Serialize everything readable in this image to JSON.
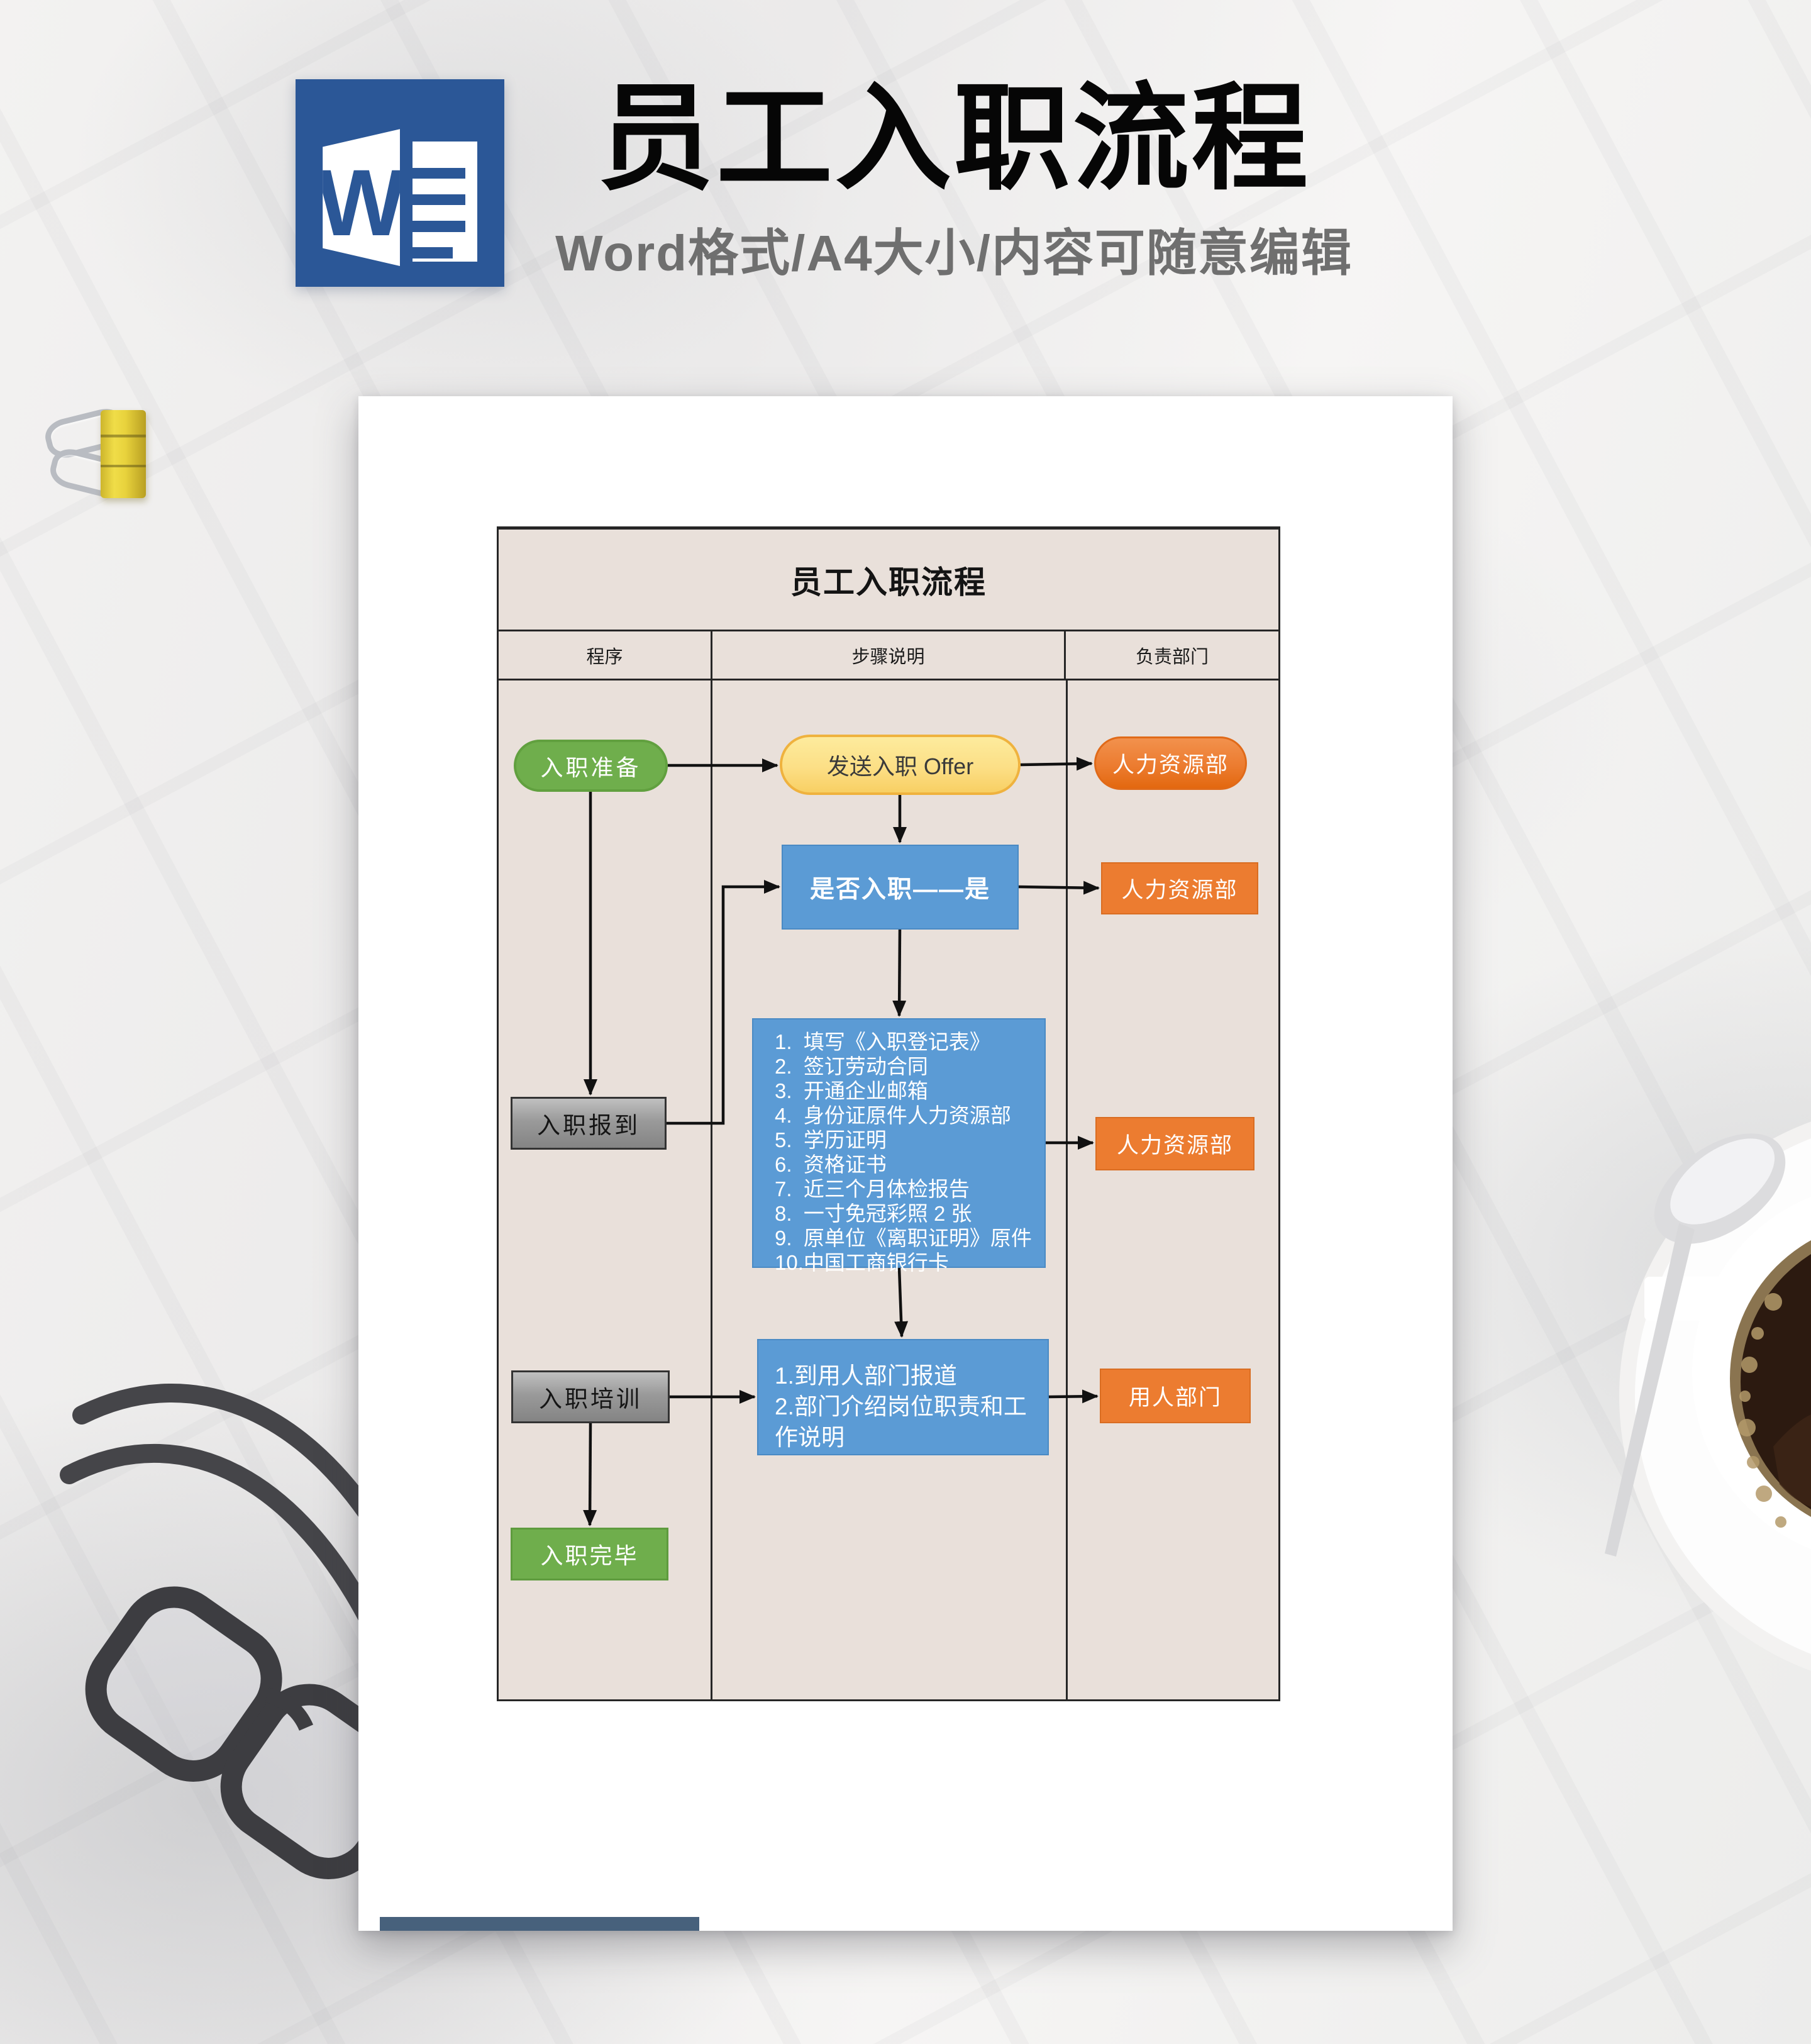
{
  "header": {
    "word_letter": "W",
    "title": "员工入职流程",
    "subtitle": "Word格式/A4大小/内容可随意编辑"
  },
  "page": {
    "table": {
      "title": "员工入职流程",
      "columns": [
        "程序",
        "步骤说明",
        "负责部门"
      ]
    },
    "nodes": {
      "prepare": "入职准备",
      "offer": "发送入职 Offer",
      "hr_offer": "人力资源部",
      "decision": "是否入职——是",
      "hr_decision": "人力资源部",
      "report": "入职报到",
      "checklist": [
        "1.  填写《入职登记表》",
        "2.  签订劳动合同",
        "3.  开通企业邮箱",
        "4.  身份证原件人力资源部",
        "5.  学历证明",
        "6.  资格证书",
        "7.  近三个月体检报告",
        "8.  一寸免冠彩照 2 张",
        "9.  原单位《离职证明》原件",
        "10.中国工商银行卡"
      ],
      "hr_checklist": "人力资源部",
      "training": "入职培训",
      "dept_report_line1": "1.到用人部门报道",
      "dept_report_line2": "2.部门介绍岗位职责和工作说明",
      "dept": "用人部门",
      "complete": "入职完毕"
    },
    "colors": {
      "green": "#6fae4c",
      "yellow": "#fcdf86",
      "orange": "#ec7c30",
      "blue": "#5b9bd5",
      "gray": "#9a9a9a",
      "table_background": "#e9e0da",
      "line": "#262626",
      "footer_bar": "#47617c",
      "word_blue": "#2b5797"
    }
  }
}
